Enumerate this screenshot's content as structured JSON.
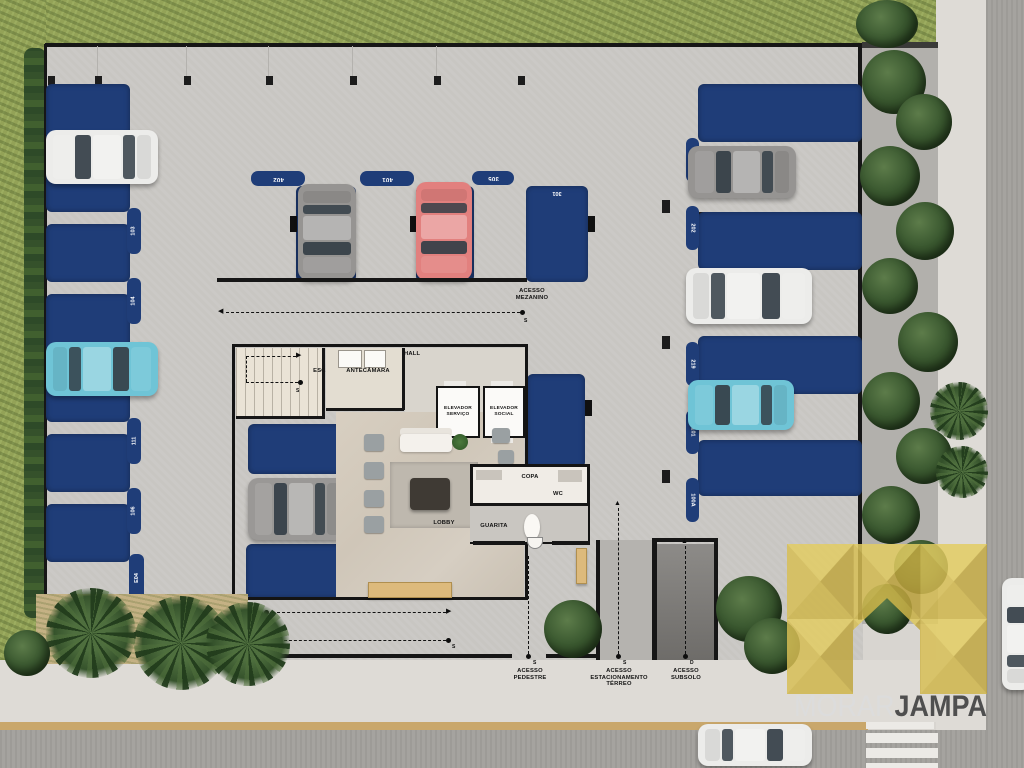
{
  "branding": {
    "word_light": "MORAR",
    "word_bold": "JAMPA"
  },
  "rooms": {
    "hall": "HALL",
    "escada": "ESCADA",
    "antecamara": "ANTECÂMARA",
    "elev_servico": [
      "ELEVADOR",
      "SERVIÇO"
    ],
    "elev_social": [
      "ELEVADOR",
      "SOCIAL"
    ],
    "lobby": "LOBBY",
    "copa": "COPA",
    "wc": "WC",
    "guarita": "GUARITA"
  },
  "access": {
    "mezanino": [
      "ACESSO",
      "MEZANINO"
    ],
    "pedestre": [
      "ACESSO",
      "PEDESTRE"
    ],
    "estacionamento": [
      "ACESSO",
      "ESTACIONAMENTO",
      "TÉRREO"
    ],
    "subsolo": [
      "ACESSO",
      "SUBSOLO"
    ]
  },
  "markers": {
    "start": "S",
    "down": "D"
  },
  "parking": {
    "top_labels": [
      "402",
      "401",
      "305",
      "301"
    ],
    "left_labels": [
      "102",
      "103",
      "104",
      "105",
      "111",
      "106",
      "E04"
    ],
    "right_labels": [
      "201",
      "202",
      "212",
      "219",
      "101",
      "100A"
    ]
  },
  "colors": {
    "parking_space": "#1f3d78",
    "logo_yellow": "#d7bf52",
    "grass": "#93a257"
  }
}
